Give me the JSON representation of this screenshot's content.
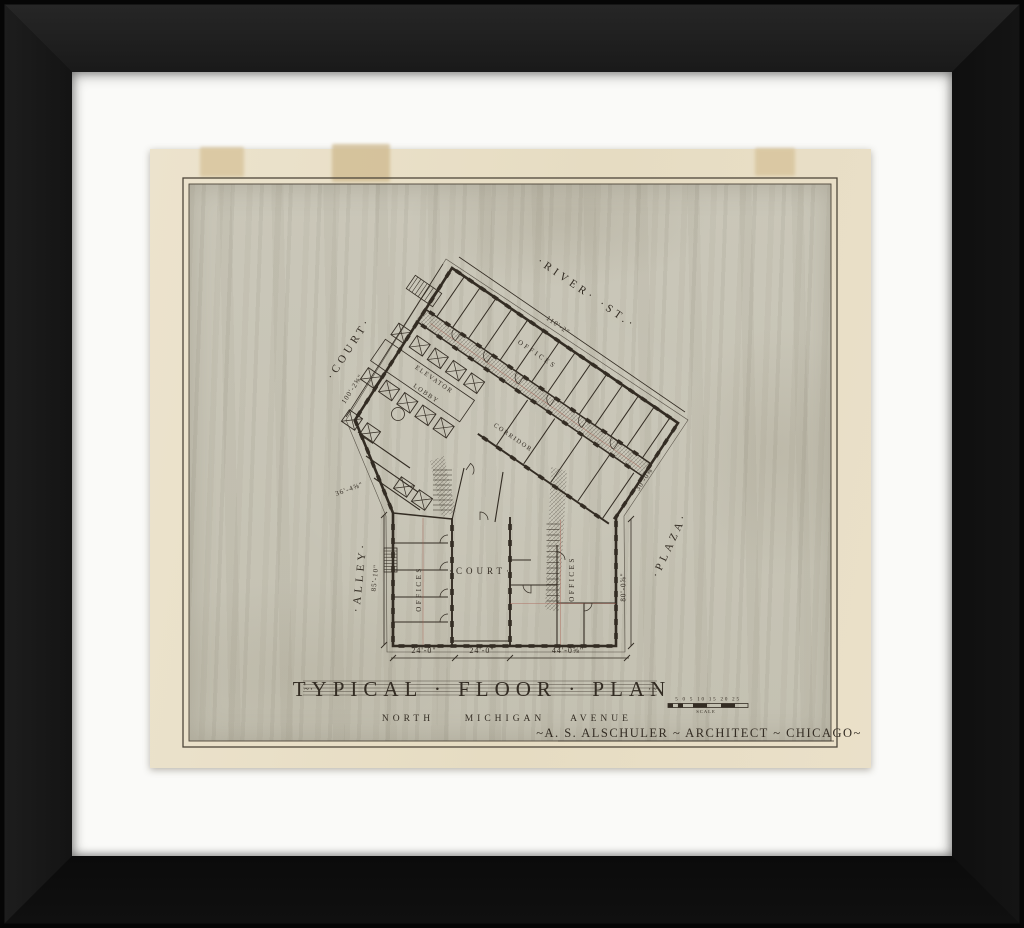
{
  "artwork": {
    "title": "TYPICAL · FLOOR · PLAN",
    "title_ornament_left": "~·",
    "title_ornament_right": "·~",
    "subtitle": {
      "w1": "NORTH",
      "w2": "MICHIGAN",
      "w3": "AVENUE"
    },
    "credit": "~A. S. ALSCHULER ~ ARCHITECT ~ CHICAGO~",
    "scale": {
      "numbers": "5 0 5 10 15 20 25",
      "label": "SCALE"
    }
  },
  "plan": {
    "streets": {
      "river": "·RIVER· ·ST.·",
      "court": "·COURT·",
      "alley": "·ALLEY·",
      "plaza": "·PLAZA·"
    },
    "rooms": {
      "court": "·COURT·",
      "corridor": "CORRIDOR",
      "offices": "OFFICES",
      "elevator_1": "ELEVATOR",
      "elevator_2": "LOBBY"
    },
    "dimensions": {
      "river": "110'-2\"",
      "court": "100'-2⅝\"",
      "alley": "85'-10\"",
      "left_diag": "36'-4⅝\"",
      "right_diag": "30'-0⅝\"",
      "plaza": "80'-0⅝\"",
      "bottom_left": "24'-0\"",
      "bottom_mid": "24'-0\"",
      "bottom_right": "44'-0⅝\""
    }
  },
  "colors": {
    "ink": "#332c23",
    "red_line": "#a85a4b",
    "border_line": "#4e463a",
    "paper": "#e8dec6",
    "field": "#c8c5b7",
    "mat": "#fafaf8",
    "frame": "#141414",
    "tape": "#d7c39a"
  }
}
